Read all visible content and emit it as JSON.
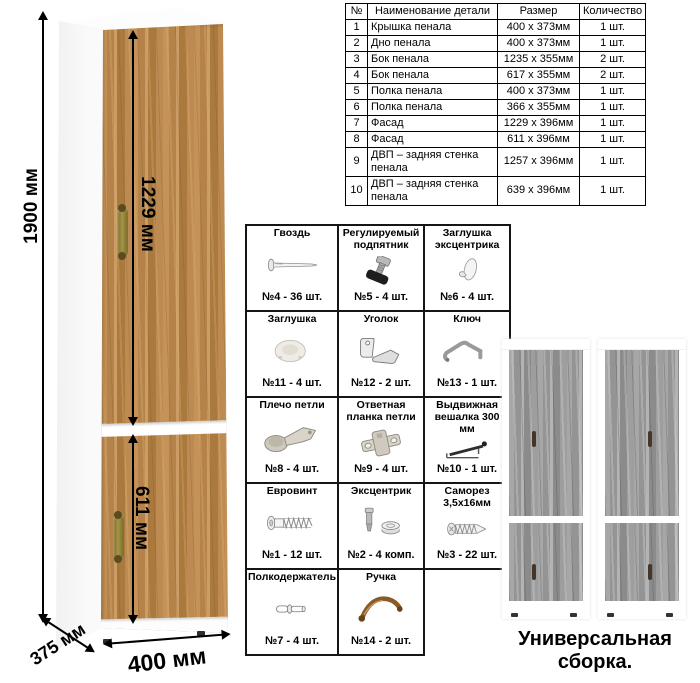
{
  "colors": {
    "wood_oak": "#b8874a",
    "wood_gray": "#9c9c9c",
    "brass_handle": "#9c8b3c",
    "line": "#000000"
  },
  "cabinet": {
    "dim_height": "1900 мм",
    "dim_upper_door": "1229 мм",
    "dim_lower_door": "611 мм",
    "dim_depth": "375 мм",
    "dim_width": "400 мм"
  },
  "parts_table": {
    "headers": [
      "№",
      "Наименование детали",
      "Размер",
      "Количество"
    ],
    "rows": [
      {
        "num": "1",
        "name": "Крышка пенала",
        "size": "400 х 373мм",
        "qty": "1 шт."
      },
      {
        "num": "2",
        "name": "Дно пенала",
        "size": "400 х 373мм",
        "qty": "1 шт."
      },
      {
        "num": "3",
        "name": "Бок пенала",
        "size": "1235 х 355мм",
        "qty": "2 шт."
      },
      {
        "num": "4",
        "name": "Бок пенала",
        "size": "617 х 355мм",
        "qty": "2 шт."
      },
      {
        "num": "5",
        "name": "Полка пенала",
        "size": "400 х 373мм",
        "qty": "1 шт."
      },
      {
        "num": "6",
        "name": "Полка пенала",
        "size": "366 х 355мм",
        "qty": "1 шт."
      },
      {
        "num": "7",
        "name": "Фасад",
        "size": "1229 х 396мм",
        "qty": "1 шт."
      },
      {
        "num": "8",
        "name": "Фасад",
        "size": "611 х 396мм",
        "qty": "1 шт."
      },
      {
        "num": "9",
        "name": "ДВП – задняя стенка пенала",
        "size": "1257 х 396мм",
        "qty": "1 шт."
      },
      {
        "num": "10",
        "name": "ДВП – задняя стенка пенала",
        "size": "639 х 396мм",
        "qty": "1 шт."
      }
    ]
  },
  "hardware": {
    "items": [
      {
        "name": "Гвоздь",
        "count": "№4 - 36 шт.",
        "icon": "nail-icon"
      },
      {
        "name": "Регулируемый подпятник",
        "count": "№5 - 4 шт.",
        "icon": "adjustable-foot-icon"
      },
      {
        "name": "Заглушка эксцентрика",
        "count": "№6 - 4 шт.",
        "icon": "cam-cover-icon"
      },
      {
        "name": "Заглушка",
        "count": "№11 - 4 шт.",
        "icon": "plug-icon"
      },
      {
        "name": "Уголок",
        "count": "№12 - 2 шт.",
        "icon": "corner-bracket-icon"
      },
      {
        "name": "Ключ",
        "count": "№13 - 1 шт.",
        "icon": "hex-key-icon"
      },
      {
        "name": "Плечо петли",
        "count": "№8 - 4 шт.",
        "icon": "hinge-arm-icon"
      },
      {
        "name": "Ответная планка петли",
        "count": "№9 - 4 шт.",
        "icon": "hinge-plate-icon"
      },
      {
        "name": "Выдвижная вешалка 300 мм",
        "count": "№10 - 1 шт.",
        "icon": "pullout-hanger-icon"
      },
      {
        "name": "Евровинт",
        "count": "№1 - 12 шт.",
        "icon": "euro-screw-icon"
      },
      {
        "name": "Эксцентрик",
        "count": "№2 - 4 комп.",
        "icon": "cam-lock-icon"
      },
      {
        "name": "Саморез 3,5х16мм",
        "count": "№3 - 22 шт.",
        "icon": "self-tapping-screw-icon"
      },
      {
        "name": "Полкодержатель",
        "count": "№7 - 4 шт.",
        "icon": "shelf-pin-icon"
      },
      {
        "name": "Ручка",
        "count": "№14 - 2 шт.",
        "icon": "handle-icon"
      }
    ]
  },
  "footer": {
    "caption": "Универсальная сборка."
  }
}
